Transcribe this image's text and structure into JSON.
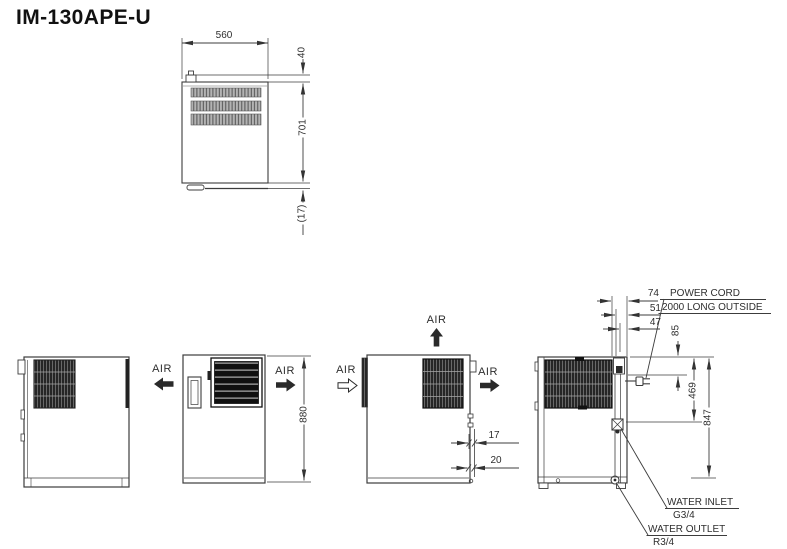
{
  "title": "IM-130APE-U",
  "top_view": {
    "dim_width": "560",
    "dim_rear_offset": "40",
    "dim_depth": "701",
    "dim_door": "(17)"
  },
  "left_side_view": {
    "air_out": "AIR"
  },
  "front_view": {
    "air_out": "AIR",
    "dim_height": "880"
  },
  "right_side_view": {
    "air_top": "AIR",
    "air_in": "AIR",
    "air_out": "AIR",
    "dim_pipe_1": "17",
    "dim_pipe_2": "20"
  },
  "rear_view": {
    "dim_offset_1": "74",
    "dim_offset_2": "51",
    "dim_offset_3": "47",
    "dim_cord_drop": "85",
    "dim_inlet_height": "469",
    "dim_overall": "847",
    "power_cord": {
      "line1": "POWER CORD",
      "line2": "2000 LONG OUTSIDE"
    },
    "water_inlet": {
      "line1": "WATER INLET",
      "line2": "G3/4"
    },
    "water_outlet": {
      "line1": "WATER OUTLET",
      "line2": "R3/4"
    }
  }
}
